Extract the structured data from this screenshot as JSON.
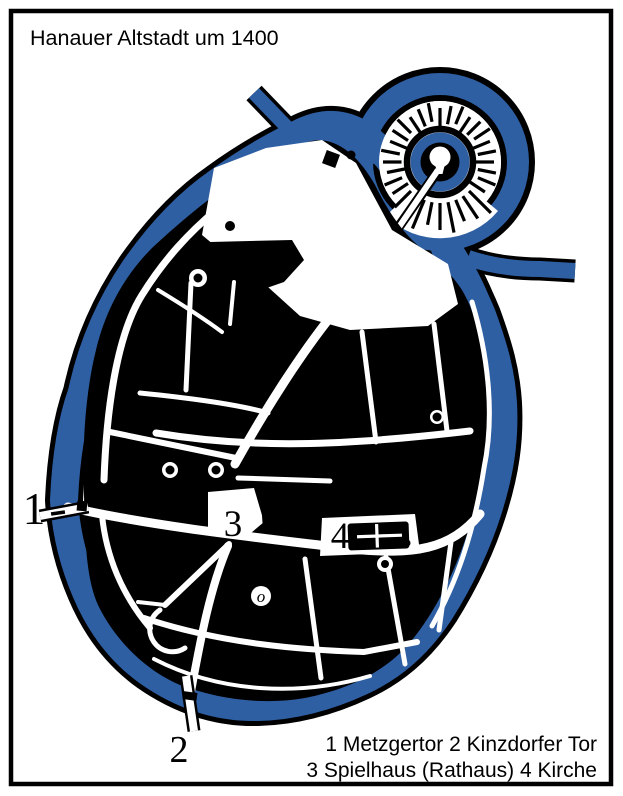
{
  "title": "Hanauer Altstadt um 1400",
  "legend": {
    "line1": "1 Metzgertor 2 Kinzdorfer Tor",
    "line2": "3 Spielhaus (Rathaus) 4 Kirche"
  },
  "markers": {
    "metzgertor": "1",
    "kinzdorfer_tor": "2",
    "spielhaus": "3",
    "kirche": "4",
    "small_o": "o"
  },
  "colors": {
    "ink": "#000000",
    "water": "#2F5FA3",
    "paper": "#FFFFFF"
  }
}
